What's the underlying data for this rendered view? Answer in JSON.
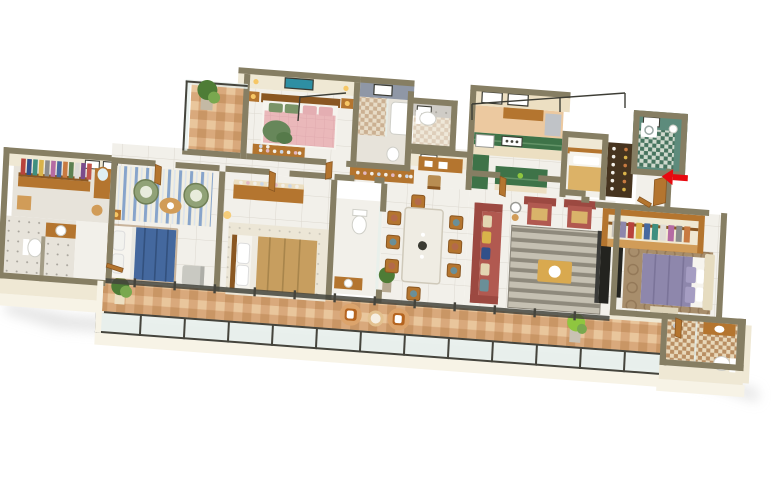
{
  "scene": {
    "kind": "3d-isometric-floor-plan-render",
    "subject": "residential-apartment",
    "view": "isometric-top",
    "background": "#ffffff"
  },
  "colors": {
    "background": "#ffffff",
    "shadow": "#dadada",
    "wallTop": "#867e63",
    "wallFace": "#efe8d4",
    "wallFaceLight": "#f7f3e6",
    "floor": "#f2f0ea",
    "floorAlt": "#e7e3da",
    "floorGrid": "#dcd8cf",
    "balconyTile": "#d9a97c",
    "balconyTileDark": "#c6915f",
    "balconyTileLight": "#ecc9a0",
    "glass": "#e7efec",
    "frame": "#45443c",
    "wood": "#b4752f",
    "woodDark": "#8a5722",
    "woodLight": "#d19c58",
    "cream": "#ecdfc2",
    "white": "#ffffff",
    "mattress": "#f6f4ee",
    "bedBlue": "#44689e",
    "bedBlueDark": "#33517e",
    "bedPink": "#eab8ba",
    "bedPinkDark": "#d79fa5",
    "bedBeige": "#c79e5f",
    "bedPurple": "#8e87ac",
    "bedTan": "#dcb267",
    "throwGreen": "#67875a",
    "sofaRed": "#b15950",
    "sofaRedDark": "#9c4941",
    "chairGreen": "#91a277",
    "rugBase": "#f1eee2",
    "rugGrayBase": "#c5c0b2",
    "rugBlue": "#7b9cc8",
    "rugGray": "#8e897c",
    "rugBrown": "#a88e6c",
    "rugBrownDark": "#8a7050",
    "kitchenGreen": "#3e7348",
    "kitchenGreenLight": "#639367",
    "tealTile": "#5d8b7c",
    "tealTileDark": "#47745f",
    "showerGray": "#8f97a6",
    "speckle": "#cfccc6",
    "checkCream": "#e8d8ba",
    "checkBrown": "#b98e62",
    "plantGreen": "#4e7c36",
    "plantLight": "#79a84f",
    "lime": "#8fc63f",
    "arrowRed": "#e8090f",
    "lampYellow": "#f6c766",
    "marbleTable": "#efece3",
    "artTeal": "#2e8fa3",
    "tvDark": "#23231f",
    "grayChair": "#c9c9c2",
    "silver": "#c0c3c7",
    "shelfDark": "#46341f"
  },
  "palettes": {
    "clothesLeft": [
      "#b8433c",
      "#31508a",
      "#3f8f7f",
      "#d9b34a",
      "#8c8c8c",
      "#b56ba3",
      "#46699f",
      "#c87a41",
      "#5c8050",
      "#dddcd6",
      "#7b4b8b",
      "#c2554a"
    ],
    "clothesRight": [
      "#c4c0b8",
      "#8e87ac",
      "#b8433c",
      "#d9b34a",
      "#46699f",
      "#3f8f7f",
      "#e0ddd6",
      "#b56ba3",
      "#8c8c8c",
      "#c87a41"
    ],
    "sofaPillows": [
      "#6a8f98",
      "#e3d6b2",
      "#31508a",
      "#d9b34a",
      "#e3d6b2"
    ],
    "diningSeats": [
      "#b36a4a",
      "#6a8f98",
      "#b36a4a",
      "#6a8f98",
      "#b36a4a",
      "#6a8f98",
      "#b36a4a",
      "#6a8f98"
    ],
    "jars": [
      "#f2efe8",
      "#d9b34a",
      "#f2efe8",
      "#c87a41",
      "#f2efe8",
      "#d9b34a",
      "#f2efe8",
      "#c87a41",
      "#f2efe8",
      "#d9b34a",
      "#f2efe8",
      "#c87a41"
    ],
    "bottles": [
      "#f2efe8",
      "#e3b8c2",
      "#f2efe8",
      "#c9d6e8",
      "#f2efe8",
      "#e3b8c2",
      "#f2efe8",
      "#c9d6e8",
      "#f2efe8"
    ]
  },
  "rooms": [
    {
      "id": "walk-in-wardrobe-west",
      "features": [
        "clothes-rack",
        "cabinet",
        "vanity-stool",
        "mirror"
      ]
    },
    {
      "id": "bathroom-west",
      "features": [
        "toilet",
        "sink-counter",
        "dotted-tile-floor"
      ]
    },
    {
      "id": "bedroom-1",
      "features": [
        "double-bed-blue",
        "green-accent-chairs",
        "coffee-table",
        "blue-striped-rug",
        "gray-armchair",
        "nightstand-lamp"
      ]
    },
    {
      "id": "bedroom-2",
      "features": [
        "double-bed-beige",
        "dresser-with-bottles",
        "light-rug",
        "table-lamp"
      ]
    },
    {
      "id": "bathroom-2",
      "features": [
        "toilet",
        "wood-vanity",
        "glass-partition"
      ]
    },
    {
      "id": "dining-room",
      "features": [
        "marble-dining-table",
        "eight-wood-chairs",
        "potted-plant",
        "centerpiece"
      ]
    },
    {
      "id": "living-room",
      "features": [
        "red-sofa",
        "two-red-armchairs",
        "gray-striped-rug",
        "coffee-table",
        "floor-lamp",
        "tv-unit"
      ]
    },
    {
      "id": "bedroom-3",
      "features": [
        "double-bed-purple",
        "cream-headboard",
        "open-wardrobe-clothes",
        "circle-pattern-rug",
        "bench",
        "tv-panel"
      ]
    },
    {
      "id": "ensuite-bathroom",
      "features": [
        "toilet",
        "wood-vanity-basin",
        "glass-shower",
        "checkered-floor"
      ]
    },
    {
      "id": "master-bedroom",
      "features": [
        "double-bed-pink",
        "green-throw",
        "wall-art-teal",
        "nightstands-lamps",
        "console-with-bottles"
      ]
    },
    {
      "id": "master-bathroom",
      "features": [
        "gray-tiled-shower",
        "tub",
        "window"
      ]
    },
    {
      "id": "toilet-room",
      "features": [
        "wc",
        "speckled-wall",
        "checkered-floor"
      ]
    },
    {
      "id": "study-nook",
      "features": [
        "wood-desk",
        "chair",
        "window"
      ]
    },
    {
      "id": "kitchen",
      "features": [
        "green-marble-l-counter",
        "green-island",
        "cooktop",
        "microwave",
        "fridge",
        "rear-cabinets"
      ]
    },
    {
      "id": "maid-room",
      "features": [
        "single-bed-tan"
      ]
    },
    {
      "id": "pantry-shelves",
      "features": [
        "dark-shelf-unit",
        "jars"
      ]
    },
    {
      "id": "utility-bathroom-green",
      "features": [
        "teal-tiles",
        "washing-machine",
        "geyser",
        "window"
      ]
    },
    {
      "id": "foyer",
      "features": [
        "entrance-door-wood",
        "red-entry-arrow"
      ]
    },
    {
      "id": "balcony-main",
      "features": [
        "terracotta-mosaic-floor",
        "glass-railing",
        "wicker-chairs",
        "round-table",
        "potted-plants"
      ]
    },
    {
      "id": "balcony-master",
      "features": [
        "terracotta-floor",
        "glass-railing",
        "potted-plant"
      ]
    }
  ],
  "entrance": {
    "marker": "red-arrow",
    "points": "west-into-foyer"
  }
}
